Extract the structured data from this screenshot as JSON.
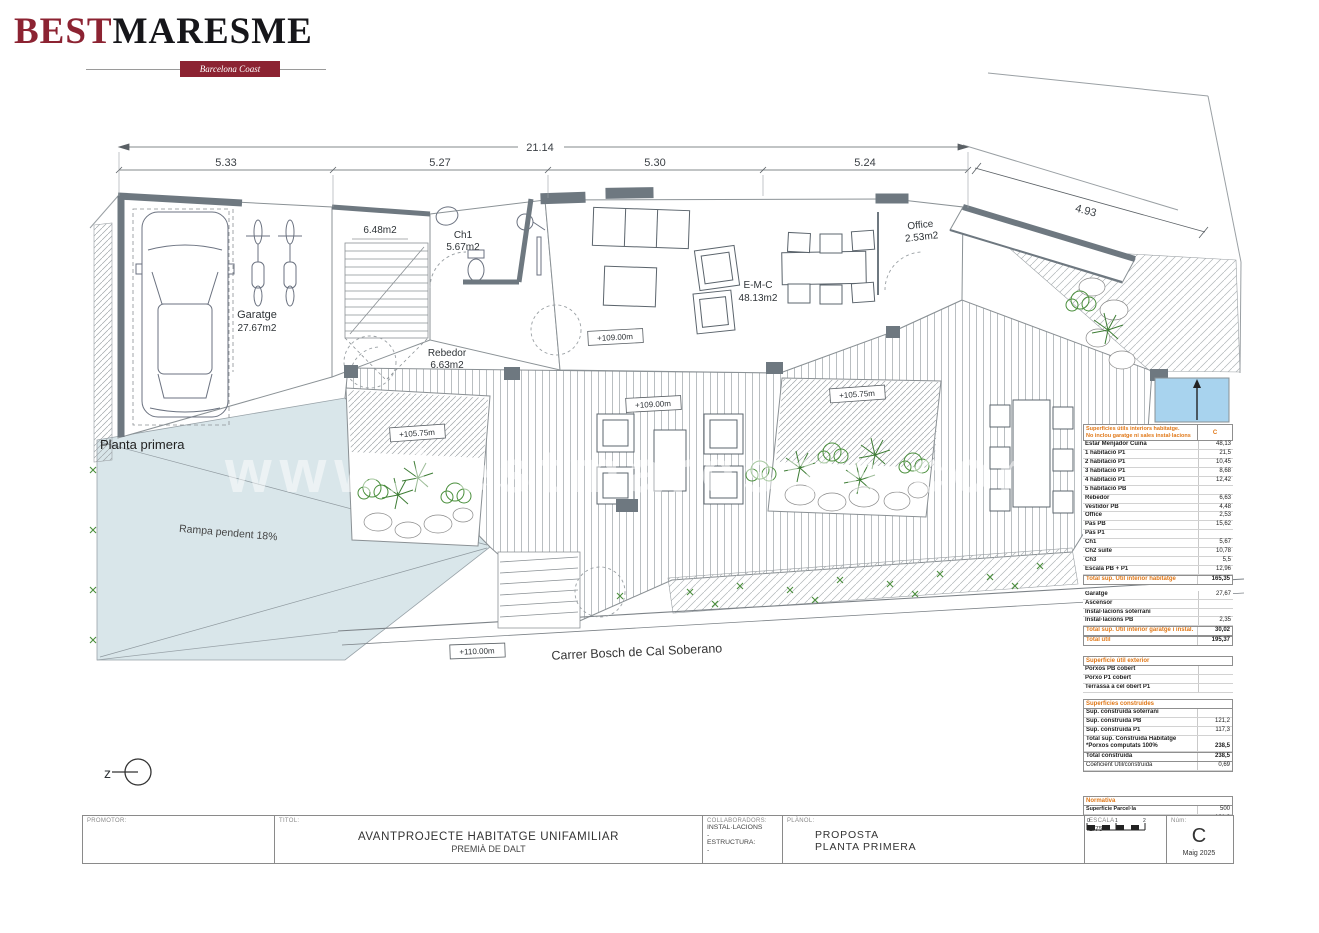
{
  "logo": {
    "best": "BEST",
    "maresme": "MARESME",
    "tagline": "Barcelona Coast Properties"
  },
  "plan": {
    "floor_label": "Planta primera",
    "ramp_label": "Rampa pendent 18%",
    "street_label": "Carrer Bosch de Cal Soberano",
    "watermark": "www.bestmaresme.com",
    "north_symbol": "z",
    "dim_total": "21.14",
    "dims": [
      "5.33",
      "5.27",
      "5.30",
      "5.24"
    ],
    "dim_right": "4.93",
    "rooms": {
      "garatge_name": "Garatge",
      "garatge_area": "27.67m2",
      "stair_area": "6.48m2",
      "ch1_name": "Ch1",
      "ch1_area": "5.67m2",
      "rebedor_name": "Rebedor",
      "rebedor_area": "6.63m2",
      "emc_name": "E-M-C",
      "emc_area": "48.13m2",
      "office_name": "Office",
      "office_area": "2.53m2"
    },
    "levels": {
      "living": "+109.00m",
      "deck": "+109.00m",
      "court_left": "+105.75m",
      "court_right": "+105.75m",
      "street": "+110.00m"
    },
    "colors": {
      "ramp_blue": "#d9e6ea",
      "pool_blue": "#a8d3ee",
      "wall_gray": "#6e7880",
      "accent_orange": "#e07818"
    }
  },
  "areas_table": {
    "header": {
      "line1": "Superficies útils interiors habitatge.",
      "line2": "No inclou garatge ni sales instal·lacions",
      "col": "C"
    },
    "interior_rows": [
      {
        "label": "Estar Menjador Cuina",
        "value": "48,13"
      },
      {
        "label": "1 habitació P1",
        "value": "21,5"
      },
      {
        "label": "2 habitació P1",
        "value": "10,45"
      },
      {
        "label": "3 habitació P1",
        "value": "8,68"
      },
      {
        "label": "4 habitació P1",
        "value": "12,42"
      },
      {
        "label": "5 habitació PB",
        "value": ""
      },
      {
        "label": "Rebedor",
        "value": "6,63"
      },
      {
        "label": "Vestidor PB",
        "value": "4,48"
      },
      {
        "label": "Office",
        "value": "2,53"
      },
      {
        "label": "Pas PB",
        "value": "15,62"
      },
      {
        "label": "Pas P1",
        "value": ""
      },
      {
        "label": "Ch1",
        "value": "5,67"
      },
      {
        "label": "Ch2 suite",
        "value": "10,78"
      },
      {
        "label": "Ch3",
        "value": "5,5"
      },
      {
        "label": "Escala PB + P1",
        "value": "12,96"
      }
    ],
    "total1": {
      "label": "Total sup. Útil interior habitatge",
      "value": "165,35"
    },
    "garage_rows": [
      {
        "label": "Garatge",
        "value": "27,67"
      },
      {
        "label": "Ascensor",
        "value": ""
      },
      {
        "label": "Instal·lacions soterrani",
        "value": ""
      },
      {
        "label": "Instal·lacions PB",
        "value": "2,35"
      }
    ],
    "total2": {
      "label": "Total sup. Útil interior garatge i instal.",
      "value": "30,02"
    },
    "total3": {
      "label": "Total útil",
      "value": "195,37"
    },
    "exterior_header": "Superficie útil exterior",
    "exterior_rows": [
      {
        "label": "Porxos PB cobert",
        "value": ""
      },
      {
        "label": "Porxo P1 cobert",
        "value": ""
      },
      {
        "label": "Terrassa a cel obert P1",
        "value": ""
      }
    ],
    "built_header": "Superficies construides",
    "built_rows": [
      {
        "label": "Sup. construida soterrani",
        "value": ""
      },
      {
        "label": "Sup. construida PB",
        "value": "121,2"
      },
      {
        "label": "Sup. construida P1",
        "value": "117,3"
      }
    ],
    "built_total": {
      "label1": "Total sup. Construida Habitatge",
      "label2": "*Porxos computats 100%",
      "value": "238,5"
    },
    "total_built": {
      "label": "Total construida",
      "value": "238,5"
    },
    "coef": {
      "label": "Coeficient Útil/construida",
      "value": "0,69"
    },
    "normativa_header": "Normativa",
    "normativa_rows": [
      {
        "label": "Superficie Parcel·la",
        "value": "500"
      },
      {
        "label": "Ocupació proposta (màx. 30% 150m2)",
        "value": "121,2"
      },
      {
        "label": "Edificabilitat proposta (màx. 0,60 300m2)",
        "value": "238,5"
      }
    ]
  },
  "title_block": {
    "promotor_label": "PROMOTOR:",
    "titol_label": "TITOL:",
    "titol_line1": "AVANTPROJECTE HABITATGE UNIFAMILIAR",
    "titol_line2": "PREMIÀ DE DALT",
    "collab_label": "COLLABORADORS:",
    "collab_1": "INSTAL·LACIONS",
    "collab_1v": "-",
    "collab_2": "ESTRUCTURA:",
    "collab_2v": "-",
    "planol_label": "PLÀNOL:",
    "planol_line1": "PROPOSTA",
    "planol_line2": "PLANTA PRIMERA",
    "escala_label": "ESCALA",
    "escala_value": "1/75",
    "scale_ticks": [
      "0",
      "1",
      "2"
    ],
    "num_label": "Núm:",
    "num_value": "C",
    "date": "Maig 2025"
  }
}
